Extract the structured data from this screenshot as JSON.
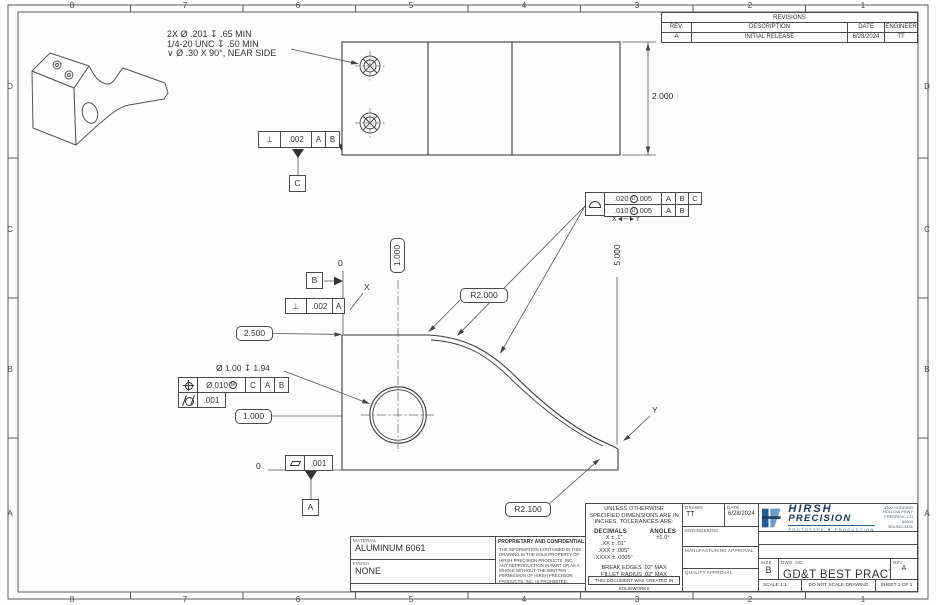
{
  "zones": {
    "cols": [
      "8",
      "7",
      "6",
      "5",
      "4",
      "3",
      "2",
      "1"
    ],
    "rows": [
      "D",
      "C",
      "B",
      "A"
    ]
  },
  "revisions": {
    "title": "REVISIONS",
    "headers": [
      "REV.",
      "DESCRIPTION",
      "DATE",
      "ENGINEER"
    ],
    "rows": [
      [
        "A",
        "INITIAL RELEASE",
        "6/28/2024",
        "TT"
      ]
    ]
  },
  "note": {
    "line1": "2X Ø .201 ↧ .65 MIN",
    "line2": "1/4-20 UNC ↧ .50 MIN",
    "line3": "∨ Ø .30 X 90°, NEAR SIDE"
  },
  "dims": {
    "top_width": "2.000",
    "overall": "5.000",
    "height_basic": "2.500",
    "hole_x_basic": "1.000",
    "hole_y_basic": "1.000",
    "radius_upper": "R2.000",
    "radius_lower": "R2.100",
    "origin_x": "0",
    "origin_y": "0",
    "point_x": "X",
    "point_y": "Y",
    "hole_callout": "Ø 1.00 ↧ 1.94"
  },
  "fcf": {
    "profile": {
      "t1": ".020",
      "m1": "U",
      "t1b": ".005",
      "d1": [
        "A",
        "B",
        "C"
      ],
      "t2": ".010",
      "m2": "U",
      "t2b": ".005",
      "d2": [
        "A",
        "B"
      ],
      "range": "X◄─►Y"
    },
    "perp_top": {
      "sym": "⊥",
      "tol": ".002",
      "datums": [
        "A",
        "B"
      ]
    },
    "perp_left": {
      "sym": "⊥",
      "tol": ".002",
      "datums": [
        "A"
      ]
    },
    "position": {
      "tol": "Ø.010",
      "mod": "M",
      "datums": [
        "C",
        "A",
        "B"
      ]
    },
    "cylindricity": {
      "tol": ".001"
    },
    "flatness": {
      "tol": ".001"
    }
  },
  "datum_labels": {
    "a": "A",
    "b": "B",
    "c": "C"
  },
  "titleblock": {
    "tol_header": "UNLESS OTHERWISE SPECIFIED DIMENSIONS ARE IN INCHES. TOLERANCES ARE:",
    "decimals_label": "DECIMALS",
    "angles_label": "ANGLES",
    "angles_val": "±1.0°",
    "tol_lines": [
      ".X ± .1\"",
      ".XX ± .01\"",
      ".XXX ± .005\"",
      ".XXXX ± .0005\""
    ],
    "break_edges": "BREAK EDGES .02\" MAX",
    "fillet": "FILLET RADIUS .02\" MAX",
    "sw_note": "THIS DOCUMENT WAS CREATED IN SOLIDWORKS",
    "drawn_label": "DRAWN",
    "date_label": "DATE",
    "drawn_by": "TT",
    "drawn_date": "6/28/2024",
    "engineering_label": "ENGINEERING",
    "mfg_label": "MANUFACTURING APPROVAL",
    "quality_label": "QUALITY APPROVAL",
    "size_label": "SIZE",
    "size": "B",
    "dwg_label": "DWG. NO.",
    "title": "GD&T BEST PRACTICES",
    "rev_label": "REV.",
    "rev": "A",
    "scale": "SCALE 1:1",
    "dns": "DO NOT SCALE DRAWING",
    "sheet": "SHEET 1 OF 1"
  },
  "material": {
    "label": "MATERIAL",
    "value": "ALUMINUM 6061",
    "finish_label": "FINISH",
    "finish": "NONE"
  },
  "proprietary": {
    "title": "PROPRIETARY AND CONFIDENTIAL",
    "body": "THE INFORMATION CONTAINED IN THIS DRAWING IS THE SOLE PROPERTY OF HIRSH PRECISION PRODUCTS, INC. ANY REPRODUCTION IN PART OR AS A WHOLE WITHOUT THE WRITTEN PERMISSION OF HIRSH PRECISION PRODUCTS, INC. IS PROHIBITED."
  },
  "logo": {
    "name1": "HIRSH",
    "name2": "PRECISION",
    "tagline": "PROTOTYPE ▼ PRODUCTION",
    "addr1": "4300 GODDING",
    "addr2": "HOLLOW PKWY",
    "addr3": "FREDRICK, CO 80504",
    "addr4": "303-530-3131"
  }
}
